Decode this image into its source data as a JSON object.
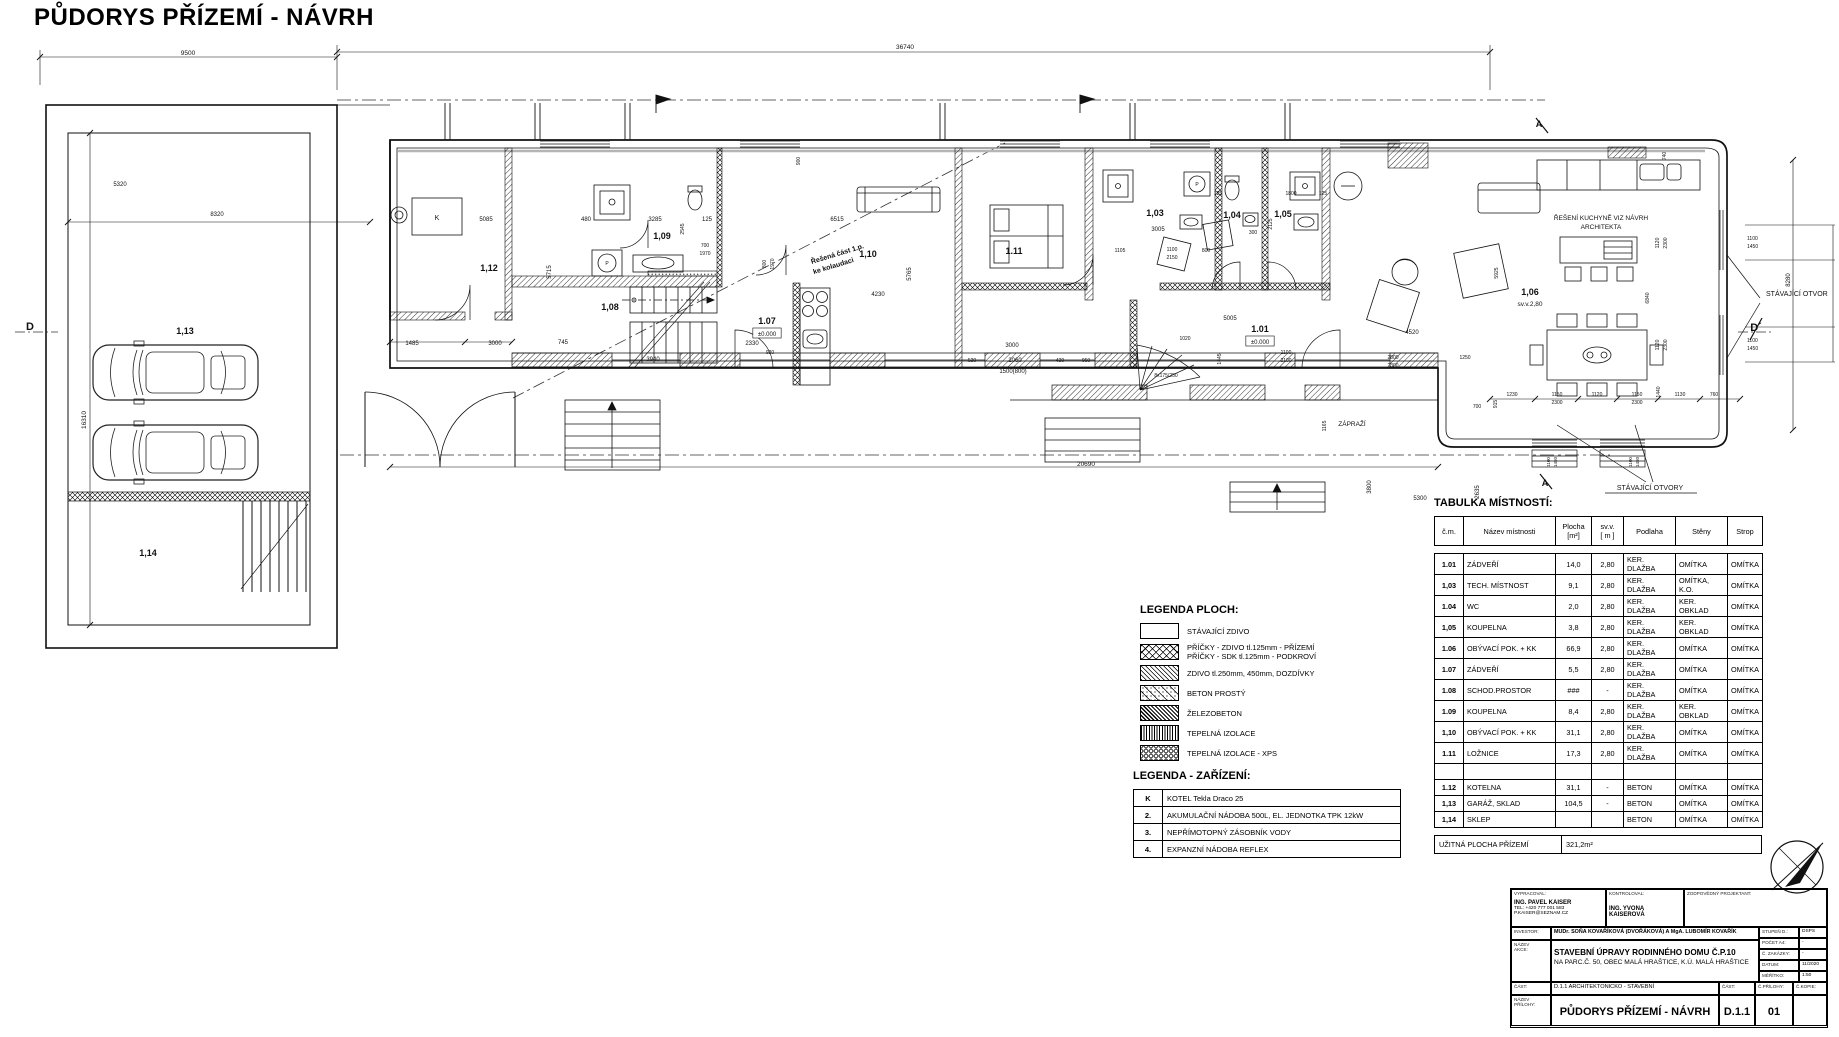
{
  "page": {
    "title": "PŮDORYS PŘÍZEMÍ - NÁVRH"
  },
  "plan": {
    "labels": [
      {
        "t": "1,13",
        "x": 185,
        "y": 334,
        "s": 9,
        "b": 1
      },
      {
        "t": "1,14",
        "x": 148,
        "y": 556,
        "s": 9,
        "b": 1
      },
      {
        "t": "1,12",
        "x": 489,
        "y": 271,
        "s": 9,
        "b": 1
      },
      {
        "t": "1,09",
        "x": 662,
        "y": 239,
        "s": 9,
        "b": 1
      },
      {
        "t": "1,08",
        "x": 610,
        "y": 310,
        "s": 9,
        "b": 1
      },
      {
        "t": "1.07",
        "x": 767,
        "y": 324,
        "s": 9,
        "b": 1
      },
      {
        "t": "±0.000",
        "x": 767,
        "y": 336,
        "s": 6,
        "box": 1
      },
      {
        "t": "1,10",
        "x": 868,
        "y": 257,
        "s": 9,
        "b": 1
      },
      {
        "t": "1.11",
        "x": 1014,
        "y": 254,
        "s": 9,
        "b": 1
      },
      {
        "t": "1,03",
        "x": 1155,
        "y": 216,
        "s": 9,
        "b": 1
      },
      {
        "t": "1,04",
        "x": 1232,
        "y": 218,
        "s": 9,
        "b": 1
      },
      {
        "t": "1,05",
        "x": 1283,
        "y": 217,
        "s": 9,
        "b": 1
      },
      {
        "t": "1.01",
        "x": 1260,
        "y": 332,
        "s": 9,
        "b": 1
      },
      {
        "t": "±0.000",
        "x": 1260,
        "y": 344,
        "s": 6,
        "box": 1
      },
      {
        "t": "1,06",
        "x": 1530,
        "y": 295,
        "s": 9,
        "b": 1
      },
      {
        "t": "sv.v.2,80",
        "x": 1530,
        "y": 306,
        "s": 6.5
      },
      {
        "t": "K",
        "x": 437,
        "y": 220,
        "s": 7
      },
      {
        "t": "P",
        "x": 607,
        "y": 265,
        "s": 5
      },
      {
        "t": "P",
        "x": 1197,
        "y": 186,
        "s": 5
      },
      {
        "t": "Řešená část 1.p.",
        "x": 838,
        "y": 256,
        "s": 7,
        "r": -17,
        "b": 1
      },
      {
        "t": "ke kolaudaci",
        "x": 834,
        "y": 268,
        "s": 7,
        "r": -17,
        "b": 1
      },
      {
        "t": "ŘEŠENÍ KUCHYNĚ VIZ NÁVRH",
        "x": 1601,
        "y": 220,
        "s": 6.5
      },
      {
        "t": "ARCHITEKTA",
        "x": 1601,
        "y": 229,
        "s": 6.5
      },
      {
        "t": "STÁVAJÍCÍ OTVOR",
        "x": 1766,
        "y": 296,
        "s": 7,
        "a": "start"
      },
      {
        "t": "STÁVAJÍCÍ OTVORY",
        "x": 1650,
        "y": 490,
        "s": 7
      },
      {
        "t": "ZÁPRAŽÍ",
        "x": 1352,
        "y": 426,
        "s": 6.5
      },
      {
        "t": "D",
        "x": 30,
        "y": 330,
        "s": 11,
        "b": 1
      },
      {
        "t": "D´",
        "x": 1756,
        "y": 331,
        "s": 11,
        "b": 1
      },
      {
        "t": "A",
        "x": 1539,
        "y": 127,
        "s": 9,
        "b": 1
      },
      {
        "t": "A",
        "x": 1545,
        "y": 486,
        "s": 9,
        "b": 1
      },
      {
        "t": "8x175/250",
        "x": 1166,
        "y": 377,
        "s": 5
      },
      {
        "t": "9500",
        "x": 188,
        "y": 55,
        "s": 6.5
      },
      {
        "t": "36740",
        "x": 905,
        "y": 49,
        "s": 6.5
      },
      {
        "t": "16310",
        "x": 86,
        "y": 420,
        "s": 6.5,
        "r": -90
      },
      {
        "t": "5320",
        "x": 120,
        "y": 186,
        "s": 6
      },
      {
        "t": "8320",
        "x": 217,
        "y": 216,
        "s": 6
      },
      {
        "t": "5085",
        "x": 486,
        "y": 221,
        "s": 6
      },
      {
        "t": "1485",
        "x": 412,
        "y": 345,
        "s": 6
      },
      {
        "t": "3000",
        "x": 495,
        "y": 345,
        "s": 6
      },
      {
        "t": "745",
        "x": 563,
        "y": 344,
        "s": 6
      },
      {
        "t": "480",
        "x": 586,
        "y": 221,
        "s": 6
      },
      {
        "t": "3285",
        "x": 655,
        "y": 221,
        "s": 6
      },
      {
        "t": "125",
        "x": 707,
        "y": 221,
        "s": 6
      },
      {
        "t": "6515",
        "x": 837,
        "y": 221,
        "s": 6
      },
      {
        "t": "5715",
        "x": 551,
        "y": 272,
        "s": 6,
        "r": -90
      },
      {
        "t": "2545",
        "x": 684,
        "y": 229,
        "s": 5,
        "r": -90
      },
      {
        "t": "700",
        "x": 705,
        "y": 247,
        "s": 5
      },
      {
        "t": "1970",
        "x": 705,
        "y": 255,
        "s": 5
      },
      {
        "t": "800",
        "x": 766,
        "y": 264,
        "s": 5,
        "r": -90
      },
      {
        "t": "1970",
        "x": 774,
        "y": 264,
        "s": 5,
        "r": -90
      },
      {
        "t": "900",
        "x": 800,
        "y": 161,
        "s": 5,
        "r": -90
      },
      {
        "t": "2330",
        "x": 752,
        "y": 345,
        "s": 6
      },
      {
        "t": "920",
        "x": 770,
        "y": 354,
        "s": 5
      },
      {
        "t": "3940",
        "x": 653,
        "y": 361,
        "s": 6
      },
      {
        "t": "4230",
        "x": 878,
        "y": 296,
        "s": 6
      },
      {
        "t": "5765",
        "x": 911,
        "y": 274,
        "s": 6,
        "r": -90
      },
      {
        "t": "3000",
        "x": 1012,
        "y": 347,
        "s": 6
      },
      {
        "t": "2060",
        "x": 1015,
        "y": 362,
        "s": 6
      },
      {
        "t": "1500(800)",
        "x": 1013,
        "y": 373,
        "s": 6
      },
      {
        "t": "520",
        "x": 972,
        "y": 362,
        "s": 5
      },
      {
        "t": "420",
        "x": 1060,
        "y": 362,
        "s": 5
      },
      {
        "t": "950",
        "x": 1086,
        "y": 362,
        "s": 5
      },
      {
        "t": "3005",
        "x": 1158,
        "y": 231,
        "s": 6
      },
      {
        "t": "1105",
        "x": 1120,
        "y": 252,
        "s": 5
      },
      {
        "t": "1100",
        "x": 1172,
        "y": 251,
        "s": 5
      },
      {
        "t": "2150",
        "x": 1172,
        "y": 259,
        "s": 5
      },
      {
        "t": "800",
        "x": 1206,
        "y": 252,
        "s": 5
      },
      {
        "t": "125",
        "x": 1218,
        "y": 195,
        "s": 5
      },
      {
        "t": "300",
        "x": 1253,
        "y": 234,
        "s": 5
      },
      {
        "t": "1800",
        "x": 1291,
        "y": 195,
        "s": 5
      },
      {
        "t": "125",
        "x": 1323,
        "y": 195,
        "s": 5
      },
      {
        "t": "2125",
        "x": 1272,
        "y": 224,
        "s": 5,
        "r": -90
      },
      {
        "t": "5005",
        "x": 1230,
        "y": 320,
        "s": 6
      },
      {
        "t": "1020",
        "x": 1185,
        "y": 340,
        "s": 5
      },
      {
        "t": "1445",
        "x": 1221,
        "y": 359,
        "s": 5,
        "r": -90
      },
      {
        "t": "1100",
        "x": 1286,
        "y": 354,
        "s": 5
      },
      {
        "t": "2100",
        "x": 1286,
        "y": 362,
        "s": 5
      },
      {
        "t": "4520",
        "x": 1412,
        "y": 334,
        "s": 6
      },
      {
        "t": "2800",
        "x": 1393,
        "y": 359,
        "s": 5
      },
      {
        "t": "2300",
        "x": 1393,
        "y": 367,
        "s": 5
      },
      {
        "t": "1250",
        "x": 1465,
        "y": 359,
        "s": 5
      },
      {
        "t": "740",
        "x": 1666,
        "y": 156,
        "s": 5,
        "r": -90
      },
      {
        "t": "1120",
        "x": 1659,
        "y": 243,
        "s": 5,
        "r": -90
      },
      {
        "t": "2300",
        "x": 1667,
        "y": 243,
        "s": 5,
        "r": -90
      },
      {
        "t": "1120",
        "x": 1659,
        "y": 345,
        "s": 5,
        "r": -90
      },
      {
        "t": "2300",
        "x": 1667,
        "y": 345,
        "s": 5,
        "r": -90
      },
      {
        "t": "6840",
        "x": 1649,
        "y": 298,
        "s": 5,
        "r": -90
      },
      {
        "t": "1440",
        "x": 1660,
        "y": 392,
        "s": 5,
        "r": -90
      },
      {
        "t": "5925",
        "x": 1498,
        "y": 273,
        "s": 5,
        "r": -90
      },
      {
        "t": "1100",
        "x": 1747,
        "y": 240,
        "s": 5,
        "a": "start"
      },
      {
        "t": "1450",
        "x": 1747,
        "y": 248,
        "s": 5,
        "a": "start"
      },
      {
        "t": "1100",
        "x": 1747,
        "y": 342,
        "s": 5,
        "a": "start"
      },
      {
        "t": "1450",
        "x": 1747,
        "y": 350,
        "s": 5,
        "a": "start"
      },
      {
        "t": "8280",
        "x": 1790,
        "y": 280,
        "s": 6,
        "r": -90
      },
      {
        "t": "1230",
        "x": 1512,
        "y": 396,
        "s": 5
      },
      {
        "t": "1150",
        "x": 1557,
        "y": 396,
        "s": 5
      },
      {
        "t": "1120",
        "x": 1597,
        "y": 396,
        "s": 5
      },
      {
        "t": "1150",
        "x": 1637,
        "y": 396,
        "s": 5
      },
      {
        "t": "2300",
        "x": 1557,
        "y": 404,
        "s": 5
      },
      {
        "t": "2300",
        "x": 1637,
        "y": 404,
        "s": 5
      },
      {
        "t": "1130",
        "x": 1680,
        "y": 396,
        "s": 5
      },
      {
        "t": "760",
        "x": 1714,
        "y": 396,
        "s": 5
      },
      {
        "t": "700",
        "x": 1477,
        "y": 408,
        "s": 5
      },
      {
        "t": "915",
        "x": 1497,
        "y": 404,
        "s": 5,
        "r": -90
      },
      {
        "t": "20690",
        "x": 1086,
        "y": 466,
        "s": 6.5
      },
      {
        "t": "5300",
        "x": 1420,
        "y": 500,
        "s": 6
      },
      {
        "t": "3800",
        "x": 1371,
        "y": 487,
        "s": 6,
        "r": -90
      },
      {
        "t": "2635",
        "x": 1479,
        "y": 492,
        "s": 6,
        "r": -90
      },
      {
        "t": "1165",
        "x": 1326,
        "y": 426,
        "s": 5,
        "r": -90
      },
      {
        "t": "1100",
        "x": 1550,
        "y": 462,
        "s": 4.5,
        "r": -90
      },
      {
        "t": "1450",
        "x": 1557,
        "y": 462,
        "s": 4.5,
        "r": -90
      },
      {
        "t": "1100",
        "x": 1632,
        "y": 462,
        "s": 4.5,
        "r": -90
      },
      {
        "t": "1450",
        "x": 1639,
        "y": 462,
        "s": 4.5,
        "r": -90
      }
    ]
  },
  "legend_ploch": {
    "title": "LEGENDA PLOCH:",
    "items": [
      {
        "swatch": "empty",
        "label": "STÁVAJÍCÍ ZDIVO"
      },
      {
        "swatch": "cross",
        "label": "PŘÍČKY - ZDIVO tl.125mm - PŘÍZEMÍ\nPŘÍČKY - SDK tl.125mm - PODKROVÍ"
      },
      {
        "swatch": "hatch",
        "label": "ZDIVO tl.250mm, 450mm, DOZDÍVKY"
      },
      {
        "swatch": "beton",
        "label": "BETON PROSTÝ"
      },
      {
        "swatch": "zb",
        "label": "ŽELEZOBETON"
      },
      {
        "swatch": "izol",
        "label": "TEPELNÁ IZOLACE"
      },
      {
        "swatch": "xps",
        "label": "TEPELNÁ IZOLACE - XPS"
      }
    ]
  },
  "legend_zarizeni": {
    "title": "LEGENDA - ZAŘÍZENÍ:",
    "rows": [
      {
        "key": "K",
        "text": "KOTEL Tekla Draco 25"
      },
      {
        "key": "2.",
        "text": "AKUMULAČNÍ NÁDOBA 500L, EL. JEDNOTKA TPK 12kW"
      },
      {
        "key": "3.",
        "text": "NEPŘÍMOTOPNÝ ZÁSOBNÍK VODY"
      },
      {
        "key": "4.",
        "text": "EXPANZNÍ NÁDOBA REFLEX"
      }
    ]
  },
  "rooms_table": {
    "title": "TABULKA MÍSTNOSTÍ:",
    "headers": [
      "č.m.",
      "Název místnosti",
      "Plocha\n[m²]",
      "sv.v.\n[ m ]",
      "Podlaha",
      "Stěny",
      "Strop"
    ],
    "rows": [
      [
        "1.01",
        "ZÁDVEŘÍ",
        "14,0",
        "2,80",
        "KER. DLAŽBA",
        "OMÍTKA",
        "OMÍTKA"
      ],
      [
        "1,03",
        "TECH. MÍSTNOST",
        "9,1",
        "2,80",
        "KER. DLAŽBA",
        "OMÍTKA, K.O.",
        "OMÍTKA"
      ],
      [
        "1.04",
        "WC",
        "2,0",
        "2,80",
        "KER. DLAŽBA",
        "KER. OBKLAD",
        "OMÍTKA"
      ],
      [
        "1,05",
        "KOUPELNA",
        "3,8",
        "2,80",
        "KER. DLAŽBA",
        "KER. OBKLAD",
        "OMÍTKA"
      ],
      [
        "1.06",
        "OBÝVACÍ POK. + KK",
        "66,9",
        "2,80",
        "KER. DLAŽBA",
        "OMÍTKA",
        "OMÍTKA"
      ],
      [
        "1.07",
        "ZÁDVEŘÍ",
        "5,5",
        "2,80",
        "KER. DLAŽBA",
        "OMÍTKA",
        "OMÍTKA"
      ],
      [
        "1.08",
        "SCHOD.PROSTOR",
        "###",
        "-",
        "KER. DLAŽBA",
        "OMÍTKA",
        "OMÍTKA"
      ],
      [
        "1.09",
        "KOUPELNA",
        "8,4",
        "2,80",
        "KER. DLAŽBA",
        "KER. OBKLAD",
        "OMÍTKA"
      ],
      [
        "1,10",
        "OBÝVACÍ POK. + KK",
        "31,1",
        "2,80",
        "KER. DLAŽBA",
        "OMÍTKA",
        "OMÍTKA"
      ],
      [
        "1.11",
        "LOŽNICE",
        "17,3",
        "2,80",
        "KER. DLAŽBA",
        "OMÍTKA",
        "OMÍTKA"
      ],
      [
        "",
        "",
        "",
        "",
        "",
        "",
        ""
      ],
      [
        "1.12",
        "KOTELNA",
        "31,1",
        "-",
        "BETON",
        "OMÍTKA",
        "OMÍTKA"
      ],
      [
        "1,13",
        "GARÁŽ, SKLAD",
        "104,5",
        "-",
        "BETON",
        "OMÍTKA",
        "OMÍTKA"
      ],
      [
        "1,14",
        "SKLEP",
        "",
        "",
        "BETON",
        "OMÍTKA",
        "OMÍTKA"
      ]
    ],
    "footer": {
      "label": "UŽITNÁ PLOCHA PŘÍZEMÍ",
      "value": "321,2m²"
    }
  },
  "title_block": {
    "vypracoval_label": "VYPRACOVAL:",
    "kontroloval_label": "KONTROLOVAL:",
    "zodpovedny_label": "ZODPOVĚDNÝ PROJEKTANT:",
    "author_name": "ING. PAVEL KAISER",
    "author_tel": "TEL: +420 777 001 583",
    "author_email": "P.KAISER@SEZNAM.CZ",
    "kontroloval_name": "ING. YVONA KAISEROVÁ",
    "investor_label": "INVESTOR:",
    "investor_value": "MUDr. SOŇA KOVAŘÍKOVÁ (DVOŘÁKOVÁ) A MgA. LUBOMÍR KOVAŘÍK",
    "nazev_akce_label": "NÁZEV\nAKCE:",
    "akce_line1": "STAVEBNÍ ÚPRAVY RODINNÉHO DOMU Č.P.10",
    "akce_line2": "NA PARC.Č. 50, OBEC MALÁ HRAŠTICE, K.Ú. MALÁ HRAŠTICE",
    "stupen_label": "STUPEŇ D.:",
    "stupen_value": "DSPS",
    "pocet_label": "POČET A4:",
    "pocet_value": "-",
    "zakazky_label": "Č. ZAKÁZKY:",
    "zakazky_value": "-",
    "datum_label": "DATUM:",
    "datum_value": "11/2020",
    "meritko_label": "MĚŘÍTKO:",
    "meritko_value": "1:50",
    "cast_label": "ČÁST:",
    "cast_value": "D.1.1 ARCHITEKTONICKO - STAVEBNÍ",
    "cast2_label": "ČÁST:",
    "prilohy_label": "Č.PŘÍLOHY:",
    "kopie_label": "Č.KOPIE:",
    "nazev_prilohy_label": "NÁZEV\nPŘÍLOHY:",
    "priloha_title": "PŮDORYS PŘÍZEMÍ - NÁVRH",
    "cast_code": "D.1.1",
    "priloha_num": "01"
  }
}
